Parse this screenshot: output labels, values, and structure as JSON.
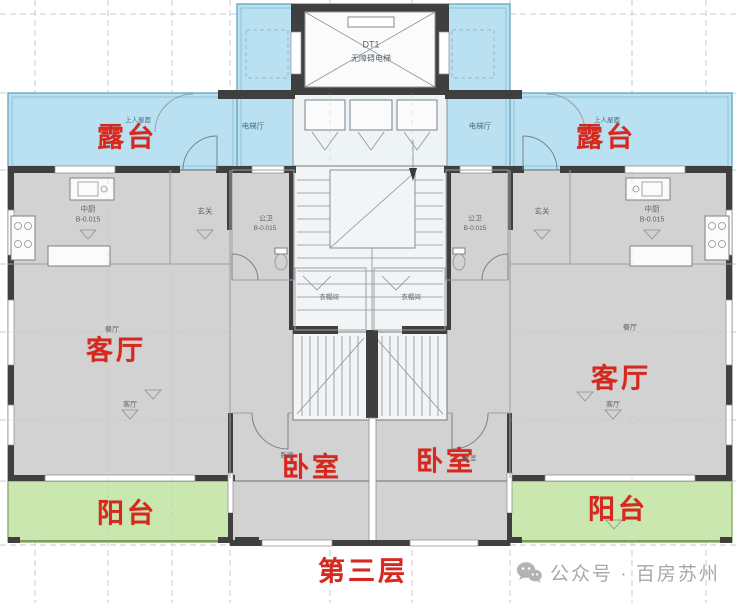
{
  "title": "residential-floor-plan",
  "colors": {
    "terrace_blue": "#b9e1f1",
    "balcony_green": "#c9e7ae",
    "room_gray": "#d2d2d2",
    "wall_dark": "#3f3f3f",
    "label_red": "#d5281e",
    "watermark_gray": "#a8a8a8"
  },
  "rooms": {
    "terrace_left": "露台",
    "terrace_right": "露台",
    "living_left": "客厅",
    "living_right": "客厅",
    "bedroom_left": "卧室",
    "bedroom_right": "卧室",
    "balcony_left": "阳台",
    "balcony_right": "阳台"
  },
  "floor_label": "第三层",
  "plan_annotations": {
    "elevator_id": "DT1",
    "elevator_name": "无障碍电梯",
    "elevator_hall_left": "电梯厅",
    "elevator_hall_right": "电梯厅",
    "roof_left": "上人屋面",
    "roof_right": "上人屋面",
    "kitchen_left": "中厨",
    "kitchen_left_level": "B-0.015",
    "kitchen_right": "中厨",
    "kitchen_right_level": "B-0.015",
    "foyer_left": "玄关",
    "foyer_right": "玄关",
    "bath_left": "公卫",
    "bath_left_level": "B-0.015",
    "bath_right": "公卫",
    "bath_right_level": "B-0.015",
    "cloak_left": "衣帽间",
    "cloak_right": "衣帽间",
    "dining_left": "餐厅",
    "dining_right": "餐厅",
    "living_small_left": "客厅",
    "living_small_right": "客厅",
    "bedroom_small_left": "卧室",
    "bedroom_small_right": "卧室"
  },
  "watermark": {
    "icon": "wechat-icon",
    "text": "公众号 · 百房苏州"
  }
}
